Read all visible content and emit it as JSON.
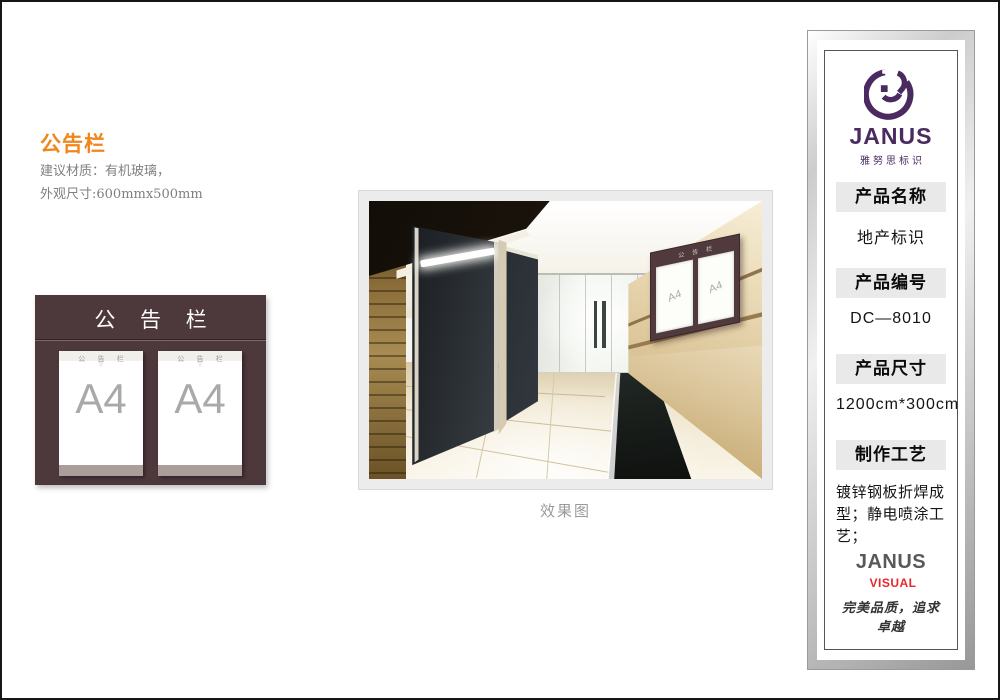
{
  "page": {
    "title": "公告栏",
    "material_line": "建议材质：有机玻璃，",
    "size_line": "外观尺寸:600mmx500mm",
    "caption": "效果图",
    "accent_color": "#f0861c",
    "border_color": "#161616"
  },
  "board": {
    "title": "公 告 栏",
    "color": "#4d383c",
    "pocket_strip_color": "#ab9d99",
    "pockets": [
      {
        "header": "公 告 栏",
        "label": "A4"
      },
      {
        "header": "公 告 栏",
        "label": "A4"
      }
    ]
  },
  "photo_sign": {
    "header": "公 告 栏",
    "color": "#503a3e",
    "pockets": [
      {
        "label": "A4"
      },
      {
        "label": "A4"
      }
    ]
  },
  "panel": {
    "logo_text": "JANUS",
    "logo_subtext": "雅努思标识",
    "logo_color": "#4a2a5f",
    "header_bar_color": "#e9e9e9",
    "sections": [
      {
        "label": "产品名称",
        "value": "地产标识"
      },
      {
        "label": "产品编号",
        "value": "DC—8010"
      },
      {
        "label": "产品尺寸",
        "value": "1200cm*300cm"
      },
      {
        "label": "制作工艺",
        "value": "镀锌钢板折焊成型；静电喷涂工艺；"
      }
    ],
    "footer_brand": "JANUS",
    "footer_brand2": "VISUAL",
    "footer_brand2_color": "#e8262a",
    "footer_slogan": "完美品质，追求卓越"
  }
}
